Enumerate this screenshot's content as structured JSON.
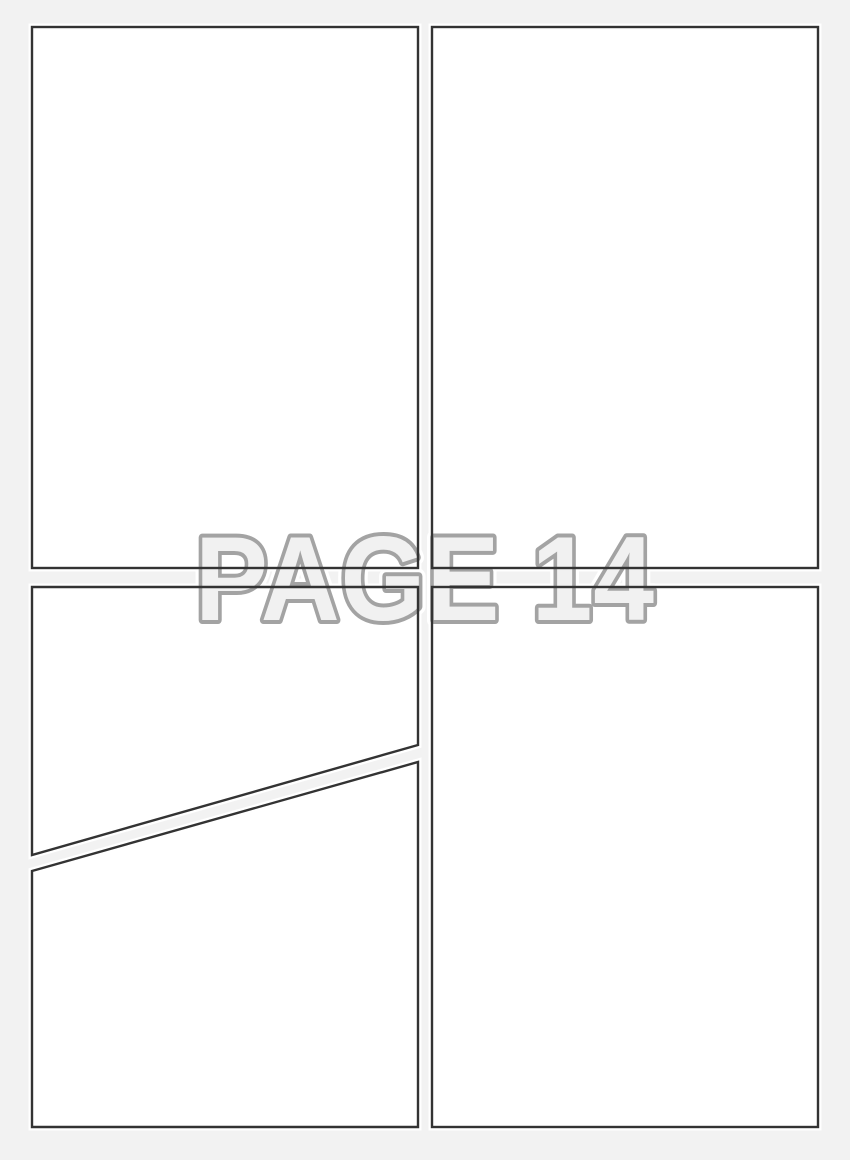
{
  "watermark": {
    "text": "PAGE 14"
  },
  "colors": {
    "background": "#f2f2f2",
    "panel_fill": "#ffffff",
    "panel_halo": "#ffffff",
    "panel_border": "#333333",
    "watermark_fill": "#f1f1f1",
    "watermark_stroke": "#a3a3a3",
    "watermark_halo": "#ffffff"
  },
  "panels": {
    "count": 5,
    "names": [
      "top-left",
      "top-right",
      "bottom-left-upper",
      "bottom-left-lower",
      "bottom-right"
    ]
  }
}
